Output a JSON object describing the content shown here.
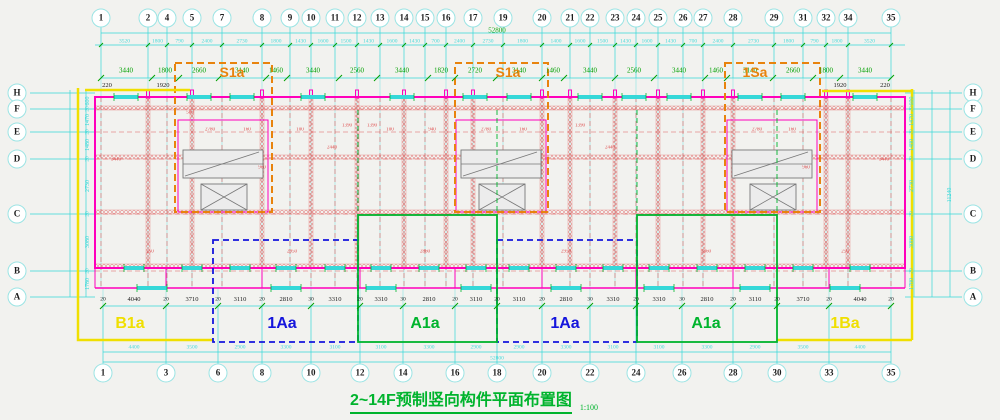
{
  "meta": {
    "drawing_title": "2~14F预制竖向构件平面布置图",
    "scale": "1:100"
  },
  "colors": {
    "paper": "#F2F2EF",
    "ink": "#1C1C1C",
    "cyan": "#35D8D8",
    "cyan_light": "#9BE4E4",
    "magenta": "#FF00BB",
    "red": "#DC4444",
    "green": "#00B42D",
    "green_dim": "#00A000",
    "yellow": "#F0DF00",
    "blue": "#1515DD",
    "orange": "#E8830D",
    "grey": "#787878"
  },
  "grid": {
    "top_labels": [
      "1",
      "2",
      "4",
      "5",
      "7",
      "8",
      "9",
      "10",
      "11",
      "12",
      "13",
      "14",
      "15",
      "16",
      "17",
      "19",
      "20",
      "21",
      "22",
      "23",
      "24",
      "25",
      "26",
      "27",
      "28",
      "29",
      "31",
      "32",
      "34",
      "35"
    ],
    "bottom_labels": [
      "1",
      "3",
      "6",
      "8",
      "10",
      "12",
      "14",
      "16",
      "18",
      "20",
      "22",
      "24",
      "26",
      "28",
      "30",
      "33",
      "35"
    ],
    "row_labels": [
      "H",
      "F",
      "E",
      "D",
      "C",
      "B",
      "A"
    ]
  },
  "dims": {
    "top_fine": [
      "3520",
      "1800",
      "790",
      "2400",
      "2730",
      "1800",
      "1430",
      "1600",
      "1500",
      "1430",
      "1600",
      "1430",
      "700",
      "2400",
      "2730",
      "1800",
      "1400",
      "1600",
      "1500",
      "1430",
      "1600",
      "1430",
      "700",
      "2400",
      "2730",
      "1800",
      "790",
      "1800",
      "3520"
    ],
    "top_total": "52800",
    "top_main": [
      "3440",
      "1800",
      "2660",
      "3140",
      "1460",
      "3440",
      "2560",
      "3440",
      "1820",
      "2720",
      "3140",
      "1460",
      "3440",
      "2560",
      "3440",
      "1460",
      "3140",
      "2660",
      "1800",
      "3440"
    ],
    "offsets": {
      "left_220": "220",
      "left_1920": "1920",
      "right_1920": "1920",
      "right_220": "220"
    },
    "bottom_main": [
      "4040",
      "3710",
      "3110",
      "2810",
      "3310",
      "3310",
      "2810",
      "3110",
      "3110",
      "2810",
      "3310",
      "3310",
      "2810",
      "3110",
      "3710",
      "4040"
    ],
    "bottom_ticks": [
      "20",
      "20",
      "20",
      "20",
      "30",
      "20",
      "30",
      "20",
      "20",
      "20",
      "30",
      "20",
      "30",
      "20",
      "20",
      "20",
      "20"
    ],
    "bottom_fine": [
      "4400",
      "3500",
      "2900",
      "3300",
      "3100",
      "3100",
      "3300",
      "2900",
      "2900",
      "3300",
      "3100",
      "3100",
      "3300",
      "2900",
      "3500",
      "4400"
    ],
    "bottom_total": "52800",
    "side_main": [
      "600",
      "1470",
      "1480",
      "2730",
      "3080",
      "1780"
    ],
    "side_joint": "20",
    "side_total": "11240",
    "interior": [
      "580",
      "2780",
      "160",
      "960",
      "100",
      "2440",
      "1390",
      "1390",
      "100",
      "940",
      "2780",
      "160",
      "1390",
      "2440",
      "2780",
      "160",
      "960",
      "250",
      "2950",
      "2860",
      "2950",
      "2860",
      "250",
      "3440",
      "3440"
    ]
  },
  "zones": {
    "units": [
      {
        "label": "B1a",
        "color_key": "yellow"
      },
      {
        "label": "1Aa",
        "color_key": "blue"
      },
      {
        "label": "A1a",
        "color_key": "green"
      },
      {
        "label": "1Aa",
        "color_key": "blue"
      },
      {
        "label": "A1a",
        "color_key": "green"
      },
      {
        "label": "1Ba",
        "color_key": "yellow"
      }
    ],
    "cores": [
      {
        "label": "S1a"
      },
      {
        "label": "S1a"
      },
      {
        "label": "1Sa"
      }
    ]
  }
}
